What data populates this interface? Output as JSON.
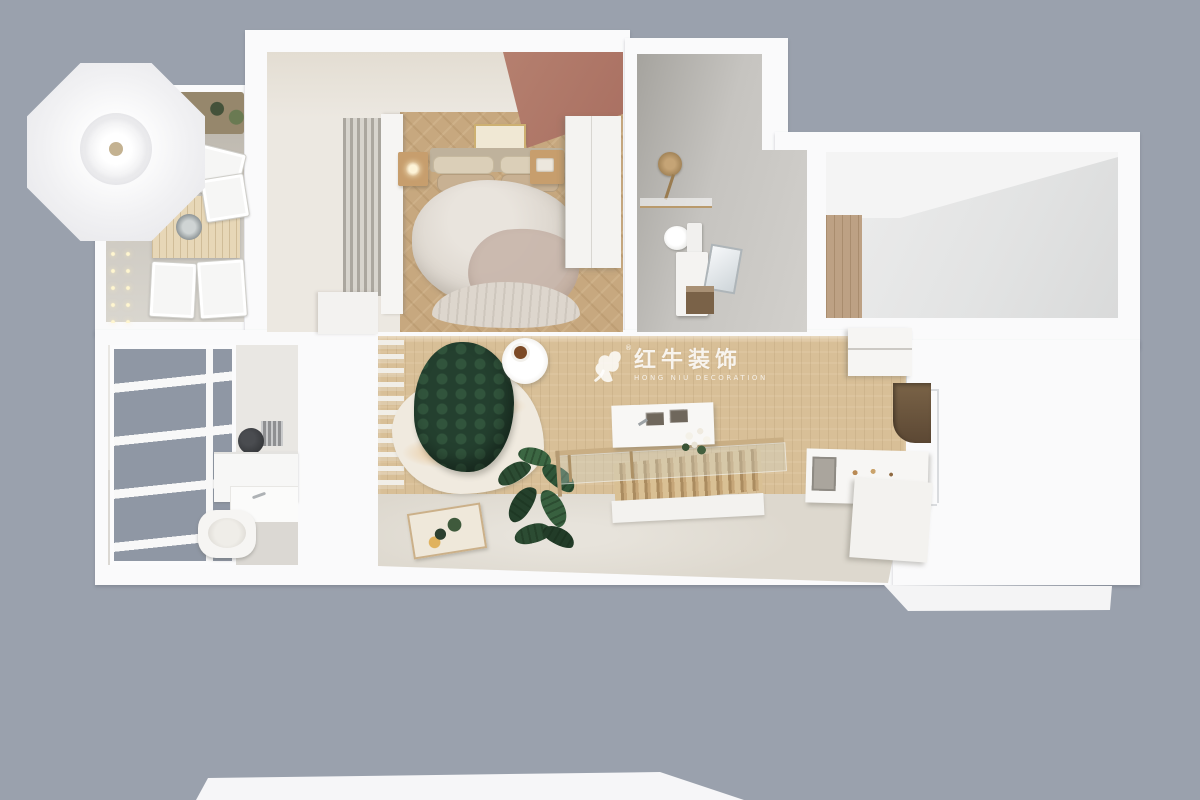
{
  "watermark": {
    "title": "红牛装饰",
    "subtitle": "HONG NIU DECORATION",
    "registered": "®"
  },
  "palette": {
    "bg": "#9aa1ad",
    "slab": "#fafafb",
    "woodLiving": "#d8bf97",
    "woodBedroom": "#c7a87f",
    "accent": "#b5806f",
    "sofa": "#24402f",
    "glassPane": "#8f97a4",
    "brass": "#c9ae84",
    "creamFloor": "#ddd8ce",
    "rug": "#f0eadf",
    "watermarkColor": "rgba(255,255,255,0.85)"
  }
}
